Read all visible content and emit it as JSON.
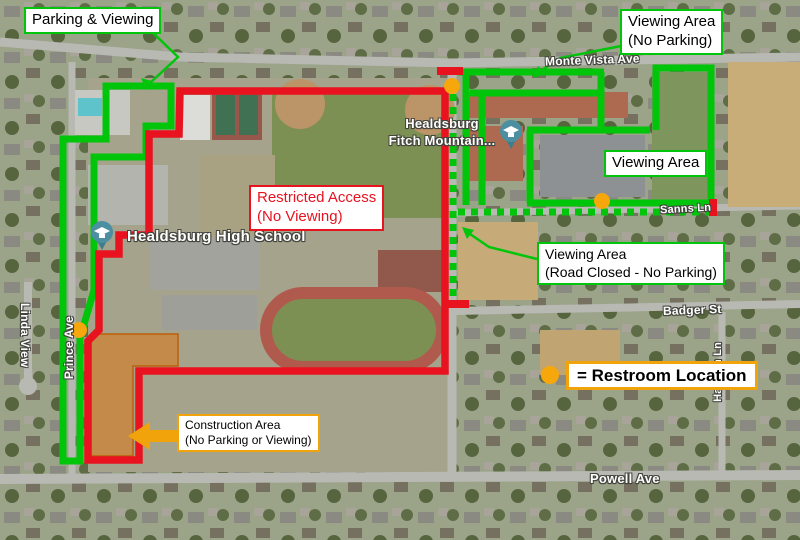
{
  "colors": {
    "viewing_green": "#00c50a",
    "restricted_red": "#e8131f",
    "marker_orange": "#f6a70b",
    "label_border_orange": "#f0a30a",
    "construction_fill": "#d97a1e"
  },
  "callouts": {
    "parking_viewing": {
      "text": "Parking & Viewing"
    },
    "viewing_no_parking": {
      "line1": "Viewing Area",
      "line2": "(No Parking)"
    },
    "viewing_area": {
      "text": "Viewing Area"
    },
    "restricted": {
      "line1": "Restricted Access",
      "line2": "(No Viewing)"
    },
    "road_closed": {
      "line1": "Viewing Area",
      "line2": "(Road Closed - No Parking)"
    },
    "construction": {
      "line1": "Construction Area",
      "line2": "(No Parking or Viewing)"
    },
    "legend": {
      "text": "= Restroom Location"
    }
  },
  "map": {
    "street_labels": [
      {
        "name": "Monte Vista Ave"
      },
      {
        "name": "Sanns Ln"
      },
      {
        "name": "Badger St"
      },
      {
        "name": "Powell Ave"
      },
      {
        "name": "Linda View"
      },
      {
        "name": "Prince Ave"
      },
      {
        "name": "Harmon Ln"
      }
    ],
    "place_labels": {
      "high_school": "Healdsburg High School",
      "fitch_line1": "Healdsburg",
      "fitch_line2": "Fitch Mountain..."
    }
  },
  "markers": {
    "restroom": [
      {
        "x": 452,
        "y": 86
      },
      {
        "x": 602,
        "y": 201
      },
      {
        "x": 79,
        "y": 330
      }
    ],
    "legend_dot": {
      "x": 550,
      "y": 375
    }
  }
}
